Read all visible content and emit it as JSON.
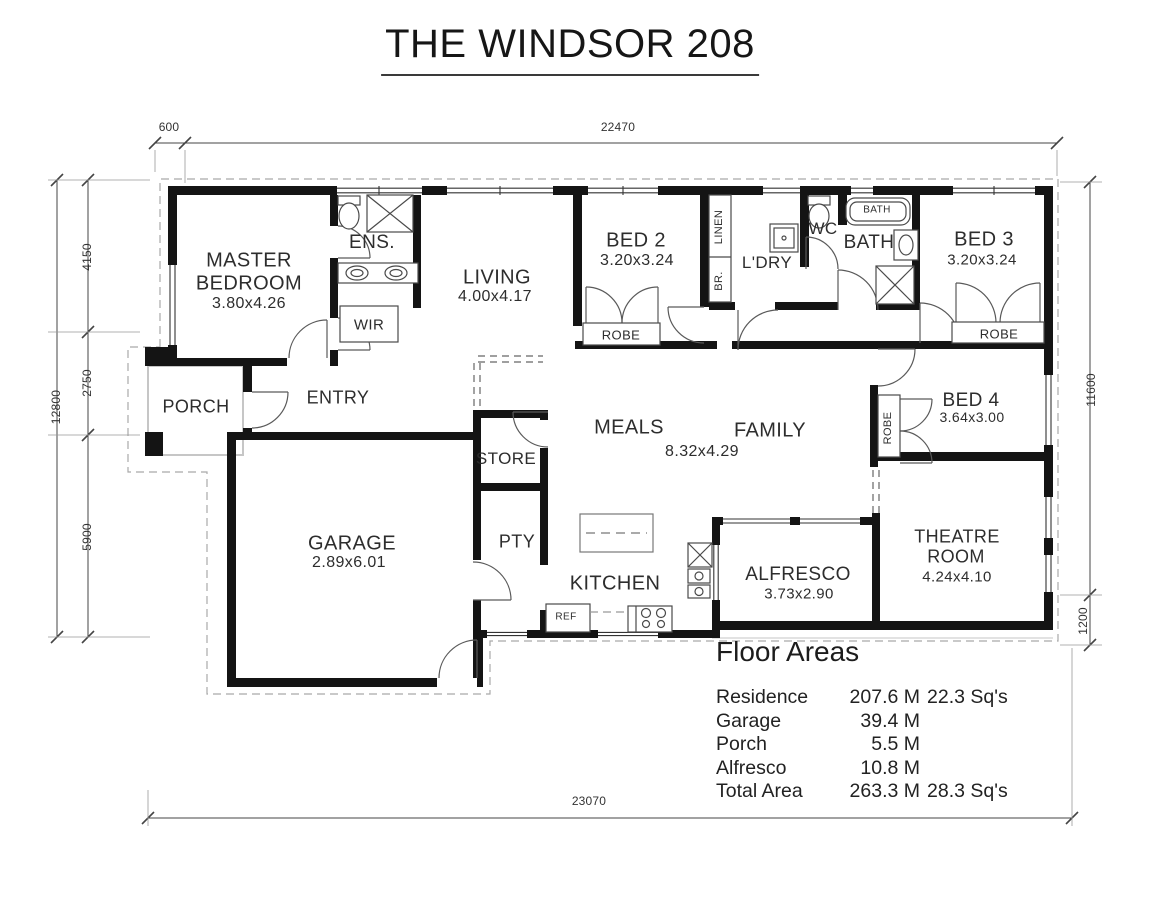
{
  "title": "THE WINDSOR 208",
  "dims": {
    "offset600": "600",
    "top": "22470",
    "left_total": "12800",
    "seg4150": "4150",
    "seg2750": "2750",
    "seg5900": "5900",
    "right_main": "11600",
    "right_low": "1200",
    "bottom": "23070"
  },
  "rooms": {
    "master1": "MASTER",
    "master2": "BEDROOM",
    "master_size": "3.80x4.26",
    "ens": "ENS.",
    "wir": "WIR",
    "living": "LIVING",
    "living_size": "4.00x4.17",
    "bed2": "BED 2",
    "bed2_size": "3.20x3.24",
    "linen": "LINEN",
    "br": "BR.",
    "robe_bed2": "ROBE",
    "ldry": "L'DRY",
    "wc": "WC",
    "bath": "BATH",
    "bath_tub": "BATH",
    "bed3": "BED 3",
    "bed3_size": "3.20x3.24",
    "robe_bed3": "ROBE",
    "porch": "PORCH",
    "entry": "ENTRY",
    "store": "STORE",
    "meals": "MEALS",
    "family": "FAMILY",
    "meals_family_size": "8.32x4.29",
    "bed4": "BED 4",
    "bed4_size": "3.64x3.00",
    "robe_bed4": "ROBE",
    "garage": "GARAGE",
    "garage_size": "2.89x6.01",
    "pty": "PTY",
    "kitchen": "KITCHEN",
    "ref": "REF",
    "alfresco": "ALFRESCO",
    "alfresco_size": "3.73x2.90",
    "theatre1": "THEATRE",
    "theatre2": "ROOM",
    "theatre_size": "4.24x4.10"
  },
  "floor_areas": {
    "heading": "Floor Areas",
    "rows": [
      {
        "label": "Residence",
        "metric": "207.6 M",
        "extra": "22.3 Sq's"
      },
      {
        "label": "Garage",
        "metric": "39.4 M",
        "extra": ""
      },
      {
        "label": "Porch",
        "metric": "5.5 M",
        "extra": ""
      },
      {
        "label": "Alfresco",
        "metric": "10.8 M",
        "extra": ""
      },
      {
        "label": "Total Area",
        "metric": "263.3 M",
        "extra": "28.3 Sq's"
      }
    ]
  }
}
